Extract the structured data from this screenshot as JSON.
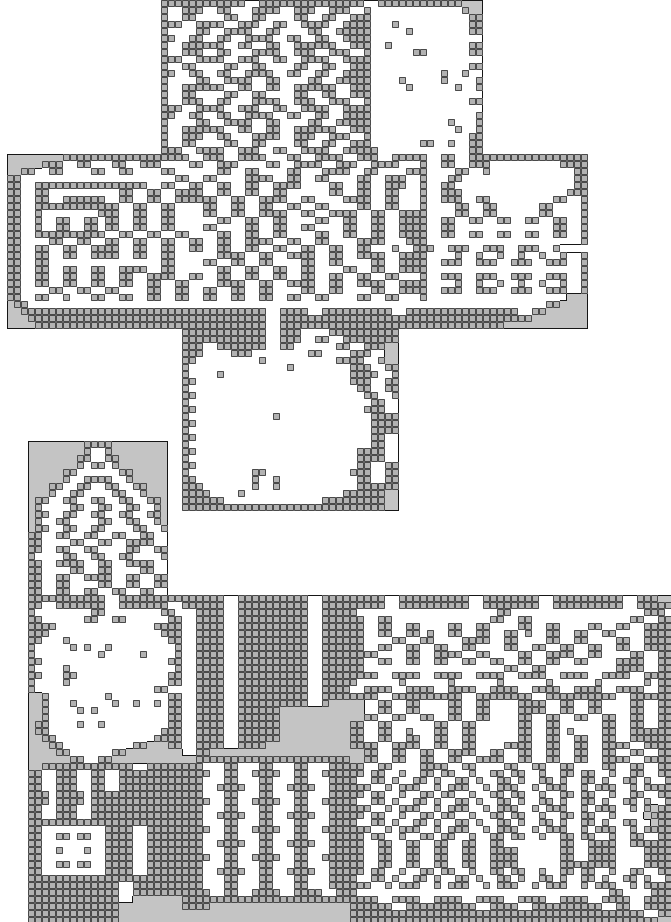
{
  "map": {
    "width_px": 671,
    "height_px": 922,
    "tile_size": 7,
    "cols": 96,
    "row_count": 132,
    "colors": {
      "page_bg": "#ffffff",
      "fog": "#c4c4c4",
      "wall_fill": "#b2b2b2",
      "wall_grid": "#4a4a4a",
      "floor": "#ffffff",
      "outline": "#161616"
    },
    "legend": {
      "s": "unexplored-blank",
      "w": "wall-tile",
      "f": "explored-floor",
      "g": "fog-revealed-unseen"
    },
    "rows": [
      "23s 12w 2f 15w 2f 12w 3g 27s",
      "23s 1w 2f 3w 2f 2w 3f 4w 2f 3w 2f 3w 2f 1w 13f 1w 2g 27s",
      "23s 1w 2f 2w 4f 2w 2f 2w 4f 2w 2f 2w 2f 3w 14f 2w 27s",
      "23s 3w 2f 4w 2f 3w 2f 2w 2f 4w 2f 3w 1w 3f 1w 10f 2w 27s",
      "23s 1w 4f 2w 2f 4w 2f 2w 4f 2w 2f 4w 1w 5f 1w 8f 2w 27s",
      "23s 2w 2f 2w 2f 2w 2f 4w 2f 2w 2f 2w 2f 3w 1w 16f 27s",
      "23s 1w 2f 6w 2f 2w 2f 2w 2f 6w 2f 2w 1w 2f 1w 11f 2w 27s",
      "23s 1w 2f 3w 2f 2w 3f 4w 2f 3w 2f 3w 2f 1w 6f 2w 6f 2w 27s",
      "23s 3w 2f 4w 2f 3w 2f 2w 2f 4w 2f 3w 1w 16f 27s",
      "23s 1w 2f 2w 4f 2w 2f 2w 4f 2w 2f 2w 2f 3w 14f 2w 27s",
      "23s 2w 2f 2w 2f 2w 2f 4w 2f 2w 2f 2w 2f 3w 1w 10f 1w 2f 1w 2f 27s",
      "23s 1w 4f 2w 2f 4w 2f 2w 4f 2w 2f 4w 1w 4f 1w 5f 1w 4f 1w 27s",
      "23s 1w 2f 6w 2f 2w 2f 2w 2f 6w 2f 2w 1w 5f 1w 6f 1w 2f 1w 27s",
      "23s 1w 2f 2w 4f 2w 2f 2w 4f 2w 2f 2w 2f 2w 1w 16f 27s",
      "23s 1w 2f 3w 2f 2w 3f 4w 2f 3w 2f 3w 2f 1w 14f 2w 27s",
      "23s 3w 2f 4w 2f 3w 2f 2w 2f 4w 2f 3w 1w 16f 27s",
      "23s 2w 2f 2w 2f 2w 2f 4w 2f 2w 2f 2w 2f 3w 1w 15f 1w 27s",
      "23s 1w 4f 2w 2f 4w 2f 2w 4f 2w 2f 4w 1w 11f 1w 3f 1w 27s",
      "23s 1w 2f 6w 2f 2w 2f 2w 2f 6w 2f 2w 1w 12f 1w 2f 1w 27s",
      "23s 1w 2f 3w 2f 2w 3f 4w 2f 3w 2f 3w 2f 1w 14f 2w 27s",
      "23s 1w 2f 2w 4f 2w 2f 2w 4f 2w 2f 2w 2f 2w 1w 7f 2w 2f 1w 2f 2w 27s",
      "23s 3w 2f 4w 2f 3w 2f 2w 2f 4w 2f 3w 2w 13f 2w 27s",
      "1s 8g 18w 2f 3w 2f 4w 3f 2w 2f 4w 2f 3w 2f 4w 1w 2f 2w 2f 2w 15w 12s",
      "1s 5g 3w 2f 2w 3f 2w 2f 3w 4f 2w 2f 3w 4f 2w 2f 4w 2f 3w 2f 4w 3f 1w 2f 2w 2f 3w 10f 4w 12s",
      "1s 2g 2w 2f 2w 4f 2w 2f 2w 4f 2w 6f 2w 2f 2w 4f 2w 3f 4w 2f 2w 4f 3w 4f 2w 2f 1w 12f 2w 12s",
      "1s 2w 22f 2w 2f 2w 4f 4w 2f 2w 2f 2w 4f 2w 2f 3w 2f 1w 3f 2w 16f 2w 12s",
      "1s 2w 2f 16w 2f 2w 2f 2w 2f 2w 2f 2w 2f 4w 4f 2w 2f 2w 2f 3w 2f 1w 2f 2w 17f 2w 12s",
      "1s 2w 2f 2w 10f 2w 2f 2w 2f 2w 2w 2f 2w 2f 2w 2f 2w 6f 2w 2f 2w 2f 2w 3f 1w 2f 3w 15f 3w 12s",
      "1s 2w 2f 2w 2f 6w 2f 2w 2f 2w 2f 2w 4w 2f 2w 2f 4w 2f 2w 4f 4w 2f 2w 3f 1w 2f 3w 2f 2w 9f 2w 2f 1w 12s",
      "1s 2w 2f 12w 2f 2w 2f 2w 2f 2f 2w 2f 2w 2f 2w 2f 2w 2f 2w 4f 2w 2f 2w 3f 1w 4f 2w 2f 2w 6f 2w 4f 1w 12s",
      "1s 2w 2f 1w 8f 3w 2f 2w 2f 2w 2f 2f 2w 2f 2w 2f 4w 2f 2w 2f 4w 2f 2w 2f 3w 1w 4f 2w 2f 2w 6f 2w 4f 1w 12s",
      "1s 2w 2f 1w 2f 2w 2f 2w 1f 2w 2f 2w 2f 2w 2f 4f 2w 2f 2w 2f 2w 4f 2w 2f 2w 2f 2w 2f 3w 1w 2f 2w 2f 2w 2f 2w 2f 2w 2f 2w 2f 1w 12s",
      "1s 2w 2f 1w 2f 2w 2f 2w 1f 2w 2f 2w 2f 2w 2f 2f 2w 4f 2w 2f 2w 2f 2w 4f 2w 2f 2w 2f 3w 1w 2f 2w 14f 2w 2f 1w 12s",
      "1s 2w 2f 10w 2f 2w 2f 2w 2f 2w 4f 2w 2f 2w 2f 2w 4f 2w 2f 2w 2f 2w 2f 3w 1w 2f 2w 2f 2w 2f 2w 2f 2w 2f 2w 2f 1w 12s",
      "1s 2w 4f 2w 2f 2w 2f 2w 2f 2w 2f 2w 2f 2w 2f 2w 2f 4w 2f 2w 2f 2w 4f 4w 3f 2w 1w 22f 1w 12s",
      "1s 2w 2f 2w 2f 2w 2f 4w 2f 2w 2f 2w 2f 2w 2f 2w 2f 2w 2f 2w 2f 2w 2f 2w 2f 2w 3f 1w 2f 3w 2f 3w 2f 3w 2f 3w 2f 1w 12s",
      "1s 2w 2f 2w 2f 2w 2f 4w 2f 2w 2f 2w 2f 4f 4w 2f 2w 2f 4w 2f 2w 2f 4w 2f 3w 1w 4f 1w 2f 1w 2f 1w 2f 1w 2f 1w 2f 1w 2f 1w 12s",
      "1s 2w 2f 2w 16f 2w 2f 2f 2w 2f 2w 2f 2w 4f 2w 2f 2w 4f 2w 2f 3w 1w 2f 3w 2f 3w 2f 3w 2f 3w 2f 1w 12s",
      "1s 2w 2f 2w 2f 2w 2f 2w 2f 4w 2f 2w 2f 4f 2w 2f 2w 2f 2w 2f 2w 4f 2w 2f 2w 2f 3w 1w 22f 1w 12s",
      "1s 2w 2f 2w 2f 2w 2f 2w 2f 2w 2f 4w 2f 2w 2f 2w 2f 2w 2f 2w 2f 2w 2f 2w 2f 2w 2f 2w 3f 1w 2f 3w 2f 3w 2f 3w 2f 3w 2f 1w 12s",
      "1s 2w 2f 2w 2f 2w 2f 2w 2f 2w 2f 2w 2f 2w 4f 4w 2f 2w 2f 4w 2f 2w 2f 4w 2f 3w 1w 4f 1w 2f 1w 2f 1w 2f 1w 2f 1w 2f 1w 2f 1w 12s",
      "1s 2w 4f 2w 2f 2w 2f 2w 4f 2w 2f 2w 2f 2w 2f 2w 2f 2w 4f 2w 2f 2w 4f 2w 2f 3w 1w 2f 3w 2f 3w 2f 3w 2f 3w 2f 1w 12s",
      "1s 2w 2f 2w 2f 1w 3f 2w 2f 2w 2f 2w 2f 2w 2f 2w 2f 2w 2f 2w 2f 2w 2f 2w 4f 2w 2f 2w 3f 1w 20f 3g 12s",
      "1s 1g 2w 23f 33f 18f 2w 4g 12s",
      "1s 2g 24w 11w 2f 4w 2f 10w 2f 2w 14w 2f 2w 6g 12s",
      "1s 3g 23w 11w 2f 20w 16w 8g 12s",
      "1s 4g 22w 11w 2f 20w 12w 12g 12s",
      "26s 12w 2f 3w 4f 10w 39s",
      "26s 12w 2f 3w 2f 2w 2f 8w 39s",
      "26s 3w 2f 7w 2f 2w 6f 2w 2f 3w 2g 39s",
      "26s 3w 4f 3w 8f 2w 4f 3w 2f 2g 39s",
      "26s 2w 9f 1w 10f 4w 2f 1w 2g 39s",
      "26s 1w 14f 1w 8f 3w 2f 2w 39s",
      "26s 1w 4f 1w 18f 4w 2f 1w 39s",
      "26s 2w 22f 3w 2f 2w 39s",
      "26s 1w 24f 2w 2f 2w 39s",
      "26s 2w 24f 2w 2f 1w 39s",
      "26s 1w 26f 2w 2f 39s",
      "26s 2w 24f 3w 2f 39s",
      "26s 1w 12f 1w 13f 4w 39s",
      "26s 2w 25f 4w 39s",
      "26s 1w 26f 4w 39s",
      "26s 2w 25f 2w 2f 39s",
      "4s 8g 4w 8g 2s 1w 26f 2w 2f 39s",
      "4s 8g 1w 2f 1w 8g 2s 2w 23f 4w 2f 39s",
      "4s 7g 2w 2f 2w 7g 2s 1w 24f 4w 2f 39s",
      "4s 7g 1w 1f 2w 1f 1w 7g 2s 2w 23f 2w 2f 2w 39s",
      "4s 5g 2w 6f 2w 5g 2s 1w 9f 2w 12f 3w 2f 2w 39s",
      "4s 5g 1w 2f 4w 2f 1w 5g 2s 2w 8f 1w 2f 1w 11f 2w 2f 2w 39s",
      "4s 3g 2w 2f 2w 2f 2w 2f 2w 3g 2s 3w 7f 1w 2f 1w 11f 6w 39s",
      "4s 3g 1w 2f 2w 4f 2w 2f 1w 3g 2s 4w 4f 1w 14f 6w 2g 39s",
      "4s 1g 2w 2f 2w 2f 2w 2f 2w 2f 2w 1g 2s 6w 14f 9w 2g 39s",
      "4s 1g 1w 4f 2w 2f 2w 2f 2w 2f 1w 1g 2s 29w 2g 39s",
      "4s 1g 2w 2f 2w 2f 2w 2f 2w 2f 2w 1g 72s",
      "4s 1g 1w 2f 2w 4f 2w 2f 2w 2f 1w 1g 72s",
      "4s 1g 2w 2f 2w 2f 2w 4f 2w 2f 1w 72s",
      "4s 2w 2f 2w 2f 2w 2f 2w 2f 2w 2f 72s",
      "4s 2w 4f 2w 2f 2w 2f 4w 2f 72s",
      "4s 2w 2f 2w 2f 2w 4f 2w 2f 2w 72s",
      "4s 1w 4f 2w 2f 2w 2f 2w 4f 1w 72s",
      "4s 2w 2f 4w 2f 2w 2f 4w 2f 72s",
      "4s 2w 4f 2w 2f 2w 4f 2w 2f 72s",
      "4s 2w 2f 2w 2f 4w 2f 2w 2f 2w 72s",
      "4s 2w 2f 2w 4f 2w 2f 2w 2f 2w 72s",
      "4s 2w 2f 2w 2f 2w 2f 2w 2f 2w 2f 72s",
      "4s 11w 2f 9w 6w 2f 10w 2f 4w 5w 2f 10w 2f 8w 2f 10w 2f 3w 2g",
      "4s 2w 2f 7w 2f 7w 2f 6w 2f 10w 2f 4w 5w 2f 10w 2f 8w 2f 10w 2f 5w",
      "4s 1w 8f 2w 8f 2w 1f 2f 4w 2f 10w 2f 4w 1w 20f 2w 19f 3w",
      "4s 2w 6f 2w 2f 2w 6f 2w 2f 4w 2f 10w 2f 4w 2w 2f 2w 14f 2w 2f 2w 14f 2w 2f 2w",
      "4s 4w 14f 4w 2f 4w 2f 10w 2f 4w 2w 2f 2w 2f 2w 4f 2w 2f 2w 4f 2w 2f 2w 4f 2w 2f 2w 2f 4w",
      "4s 3w 16f 3w 2f 4w 2f 10w 2f 4w 2w 2f 2w 2f 2w 1f 1w 2f 2w 2f 2w 2f 2w 1f 1w 2f 2w 2f 2w 2f 2w 4f 4w",
      "4s 2w 3f 1w 14f 2w 2f 4w 2f 10w 2f 4w 2w 4f 2w 2f 2w 4f 4w 2f 2w 4f 2w 2f 2w 4f 2w 2f 4w",
      "4s 1w 5f 1w 1f 1w 2f 1w 9f 1w 2f 4w 2f 10w 2f 4w 2w 2f 2w 2f 2w 2f 2w 2f 2w 4f 2w 2f 2w 2f 2w 2f 2w 2f 2w 2f 4w",
      "4s 1w 9f 1w 5f 1w 4f 1w 2f 4w 2f 10w 2f 4w 4w 4f 2w 2f 4w 2f 2w 4f 2w 2f 4w 2f 2w 4f 2w 2f 2w",
      "4s 2w 18f 2w 2f 4w 2f 10w 2f 4w 2w 2f 2w 2f 2w 2f 2w 2f 2w 2f 2w 2f 2w 2f 2w 2f 2w 4f 4w 2f 2w",
      "4s 1w 4f 1w 15f 1w 2f 4w 2f 10w 2f 4w 2w 20f 2w 2f 2w 10f 4w 2f 2w",
      "4s 2w 3f 2w 13f 2w 2f 4w 2f 10w 2f 4w 4w 2f 4w 2f 4w 2f 4w 2f 4w 2f 4w 2f 4w 2f 4w",
      "4s 1w 4f 1w 14f 2w 2f 4w 2f 10w 2f 4w 1w 6f 1w 6f 1w 6f 1w 6f 1w 6f 1w 6f 1w 1f 2w",
      "4s 1w 17f 2w 2f 2f 4w 2f 10w 2f 4w 2f 4w 2f 4w 2f 4w 2f 4w 2f 4w 2f 4w 2f 4w 2f 2w",
      "4s 2g 1w 8f 1w 8f 2w 2f 4w 2f 10w 2f 4w 4w 2f 10w 2f 8w 2f 10w 2f 6w",
      "4s 2g 1w 3f 1w 5f 1w 2f 1w 2f 1w 1f 2w 2f 4w 2f 10w 2f 1w 3g 2g 2f 2w 2f 2w 4f 2w 2f 2w 4f 4w 2f 2w 2f 2w 4f 2w 2f 2w",
      "4s 2g 1w 4f 1w 1f 1w 10f 2w 2f 4w 2f 6w 10g 2g 2f 2w 2f 2w 4f 2w 2f 2w 4f 4w 2f 2w 2f 2w 4f 2w 2f 2w",
      "4s 2g 1w 17f 2w 2f 4w 2f 6w 10g 2g 2w 2f 2w 2f 2w 2f 2w 2f 2w 4f 2w 2f 2w 2f 2w 2f 2w 2f 2w 2f 2w",
      "4s 1g 2w 4f 1w 2f 1w 9f 2w 2f 4w 2f 6w 10g 2w 2f 2w 6f 2w 2f 2w 6f 2w 2f 2w 6f 2w 2f 2w 2f 2w",
      "4s 1g 2w 16f 3w 2f 4w 2f 6w 10g 2w 2f 2w 2f 1w 3f 2w 2f 2w 6f 2w 2f 2w 1f 1w 4f 2w 2f 6w",
      "4s 2g 2w 14f 4w 2f 4w 2f 6w 10g 2w 2f 2w 2f 2w 2f 2w 2f 2w 6f 2w 2f 2w 2f 2w 2f 2w 2f 6w",
      "4s 3g 2w 10f 2w 3g 2w 2f 4w 2f 4w 12g 4w 2f 4w 2f 2w 2f 2w 4f 4w 2f 2w 2f 2w 2f 4w 2f 4w",
      "4s 4g 2w 6f 2w 8g 2f 2w 20g 2g 2w 2f 2w 2f 2w 2f 4w 2f 2w 2f 2w 2f 2w 2f 2w 2f 2w 2f 2w 2f 4w",
      "4s 6g 2w 2f 2w 10g 2g 22w 2g 2w 2f 2w 2f 2w 2f 2w 2f 4w 2f 2w 2f 2w 2f 2w 2f 4w 2f 4w",
      "4s 2g 13w 2f 5w 3w 3f 2w 3f 2w 3f 2w 3f 3w 2w 2f 2w 4f 4w 2f 2w 4f 2w 2f 2w 2f 2w 4f 2w 2f 2w 2f 2w",
      "4s 2w 2f 3w 2f 2w 2f 9w 4w 2f 2w 2f 4w 2f 2w 2f 4w 2w 1f 2w 2f 1w 2f 2w 1f 2w 2f 1w 2f 2w 1f 2w 2f 1w 2f 2w 1f 2w 2f 1w 2f 2w 2f 2w",
      "4s 2w 2f 3w 2f 2w 2f 9w 3w 3f 2w 3f 2w 3f 2w 3f 3w 1w 2f 2w 1f 1w 2f 2w 1f 1w 2f 2w 1f 1w 2f 2w 1f 1w 2f 2w 1f 1w 2f 2w 1f 1w 2f 2w 1f 1w 2f 1w",
      "4s 2w 2f 3w 2f 2w 2f 9w 3w 2f 4w 2f 2w 2f 4w 2f 3w 3w 2f 1w 1f 3w 2f 1w 1f 3w 2f 1w 1f 3w 2f 1w 1f 3w 2f 1w 1f 3w 2f 1w 1f 4w",
      "4s 3w 1f 4w 1f 13w 3w 3f 2w 3f 2w 3f 2w 3f 3w 2w 1f 2w 2f 1w 2f 2w 1f 2w 2f 1w 2f 2w 1f 2w 2f 1w 2f 2w 1f 2w 2f 1w 2f 2w 2f 2w",
      "4s 3w 1f 4w 1f 13w 4w 2f 2w 2f 4w 2f 2w 2f 4w 1w 2f 2w 1f 1w 2f 2w 1f 1w 2f 2w 1f 1w 2f 2w 1f 1w 2f 2w 1f 1w 2f 2w 1f 1w 2f 2w 1f 1w 2f 1w",
      "4s 2w 2f 3w 2f 13w 3w 3f 2w 3f 2w 3f 2w 3f 3w 3w 2f 1w 1f 3w 2f 1w 1f 3w 2f 1w 1f 3w 2f 1w 1f 3w 2f 1w 1f 3w 2f 1w 1f 1w 1g 2w",
      "4s 2w 2f 3w 2f 13w 3w 2f 4w 2f 2w 2f 4w 2f 3w 2w 1f 2w 2f 1w 2f 2w 1f 2w 2f 1w 2f 2w 1f 2w 2f 1w 2f 2w 1f 2w 2f 1w 2f 2f 1g 3w",
      "4s 22w 3w 3f 2w 3f 2w 3f 2w 3f 3w 1w 2f 2w 1f 1w 2f 2w 1f 1w 2f 2w 1f 1w 2f 2w 1f 1w 2f 2w 1f 1w 2f 2w 1f 1w 2f 2w 1f 1f 1g 2w",
      "4s 2w 9f 4w 2f 5w 4w 2f 2w 2f 4w 2f 2w 2f 4w 3w 2f 1w 1f 3w 2f 1w 1f 3w 2f 1w 1f 3w 2f 1w 1f 3w 2f 1w 1f 3w 2f 1w 1f 4w",
      "4s 2w 2f 2w 1f 2w 2f 4w 2f 5w 3w 3f 2w 3f 2w 3f 2w 3f 3w 2w 1f 2w 2f 1w 2f 2w 1f 2w 2f 1w 2f 2w 1f 2w 2f 1w 2f 2w 1f 2w 2f 1w 2f 2w 2f 2w",
      "4s 2w 9f 4w 2f 5w 3w 2f 4w 2f 2w 2f 4w 2f 3w 2w 2f 2w 2f 2w 2f 2w 2f 2w 2f 2w 2f 6f 2w 2f 4w 2f 6w",
      "4s 2w 2f 1w 3f 1w 2f 4w 2f 5w 3w 3f 2w 3f 2w 3f 2w 3f 3w 2w 2f 2w 2f 2w 2f 2w 2f 2w 2f 4w 6f 2w 2f 4w 4f 4w",
      "4s 2w 9f 4w 2f 5w 4w 2f 2w 2f 4w 2f 2w 2f 4w 2w 2f 2w 2f 2w 2f 2w 2f 2w 2f 4w 6f 2w 2f 4w 4f 4w",
      "4s 2w 2f 2w 1f 2w 2f 4w 2f 5w 3w 3f 2w 3f 2w 3f 2w 3f 3w 2w 2f 2w 2f 2w 2f 2w 2f 2w 2f 4w 6f 8w 4f 4w",
      "4s 2w 9f 4w 2f 5w 3w 2f 4w 2f 2w 2f 4w 2f 3w 2w 1f 2w 2f 1w 2f 2w 1f 2w 2f 1w 2f 2w 1f 2w 2f 1w 2f 2w 1f 2w 2f 1w 2f 2w 2f 2w",
      "4s 22w 3w 3f 2w 3f 2w 3f 2w 3f 3w 1w 2f 2w 1f 1w 2f 2w 1f 1w 2f 2w 1f 1w 2f 2w 1f 1w 2f 2w 1f 1w 2f 2w 1f 1w 2f 2w 1f 1w 2f 1w",
      "4s 13w 2f 7w 3w 3f 2w 3f 2w 3f 2w 3f 3w 3w 2f 1w 1f 3w 2f 1w 1f 3w 2f 1w 1f 3w 2f 1w 1f 3w 2f 1w 1f 3w 2f 1w 1f 4w",
      "4s 13w 2f 7w 4w 2f 2w 2f 4w 2f 4w 2f 2w 1w 36f 2w 4f 3w",
      "4s 13w 2f 7g 24w 4w 2f 4w 2f 4w 2f 4w 2f 4w 2f 4w 2f 4w 2f 4w",
      "4s 13w 9g 4w 20g 6w 2f 10w 2f 4w 2f 10w 2f 2w 2f 4w",
      "4s 13w 9g 24g 42w 2f 2w",
      "4s 13w 9g 24g 44w 2g"
    ]
  }
}
